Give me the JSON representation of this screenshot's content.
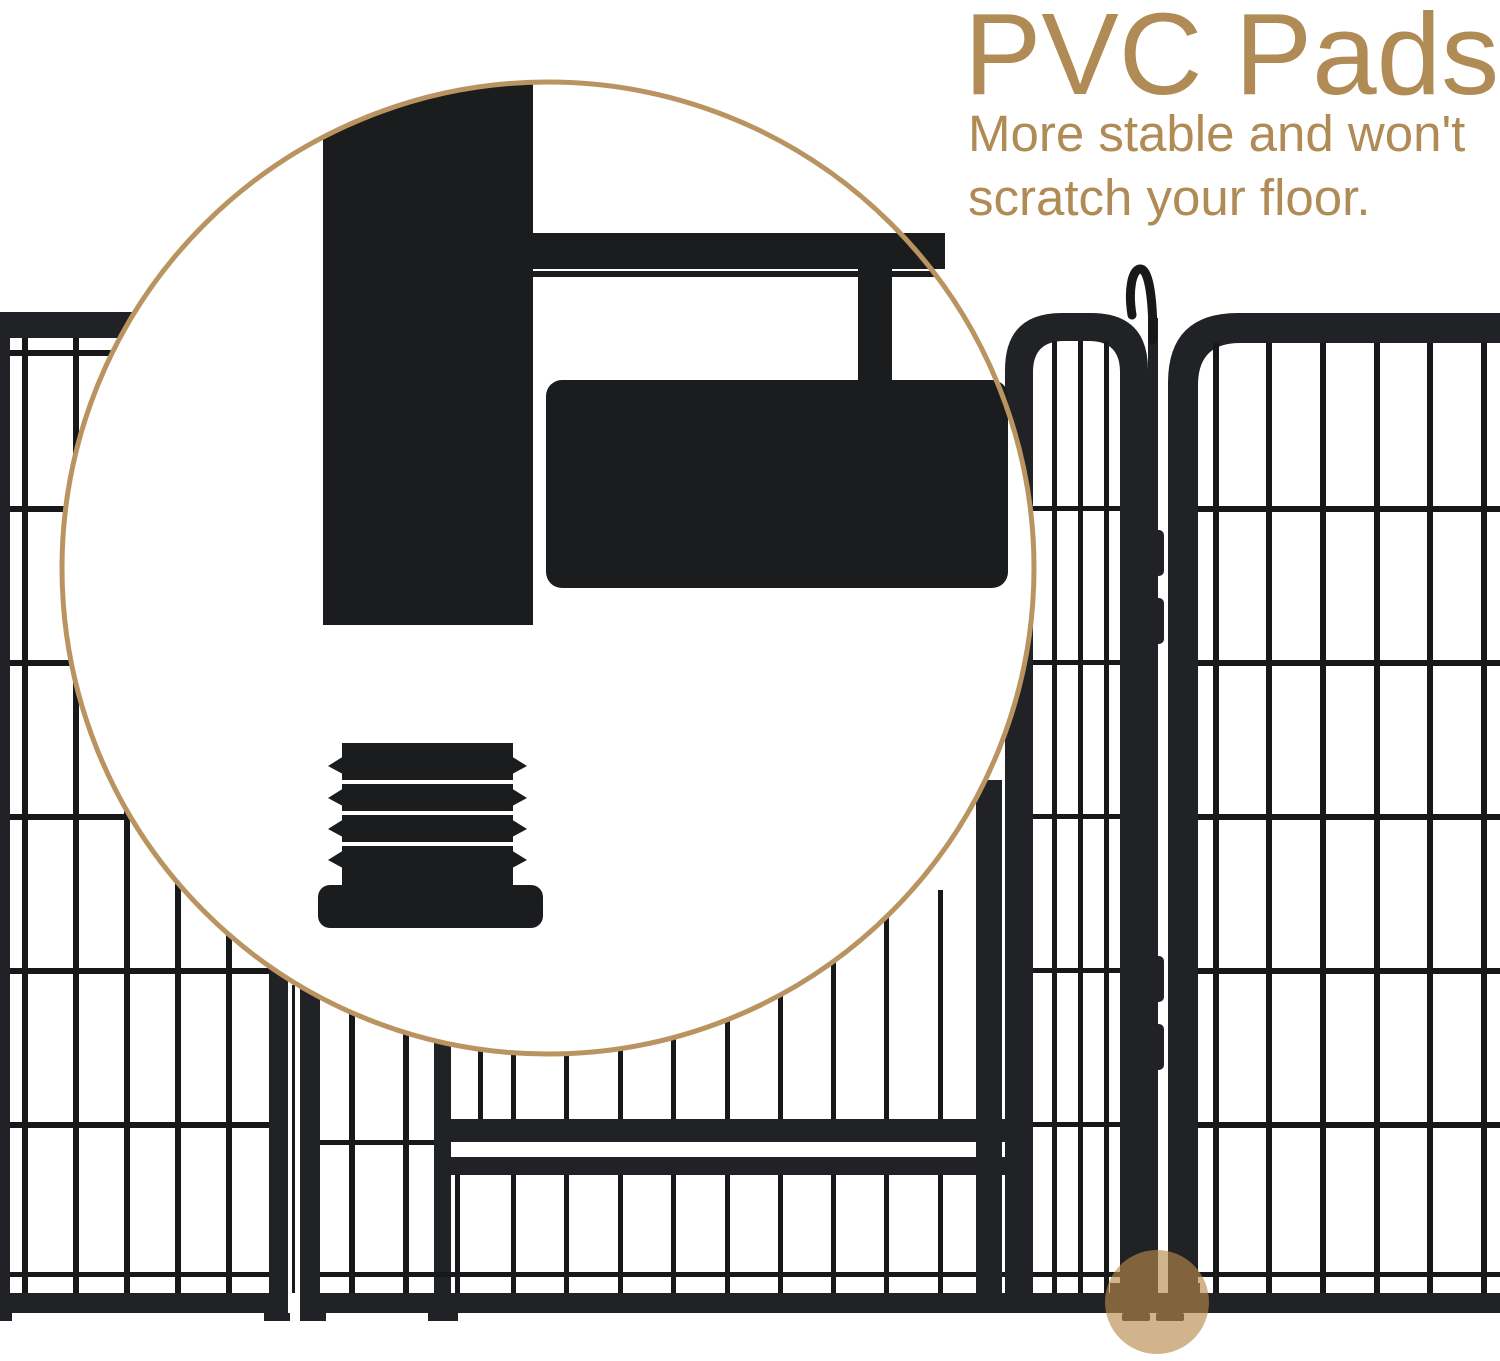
{
  "image": {
    "width": 1500,
    "height": 1361,
    "background": "#FFFFFF",
    "subject": "metal-playpen-panels-with-pvc-pad-closeup-callout"
  },
  "annotation": {
    "title": "PVC Pads",
    "subtitle_line1": "More stable and won't",
    "subtitle_line2": "scratch your floor."
  },
  "colors": {
    "accent": "#B08B55",
    "callout_border": "#BA9460",
    "fence": "#212225",
    "wire": "#17181A",
    "inset_black": "#1B1C1E",
    "highlight": "#B8894B",
    "highlight_opacity": "0.64"
  }
}
